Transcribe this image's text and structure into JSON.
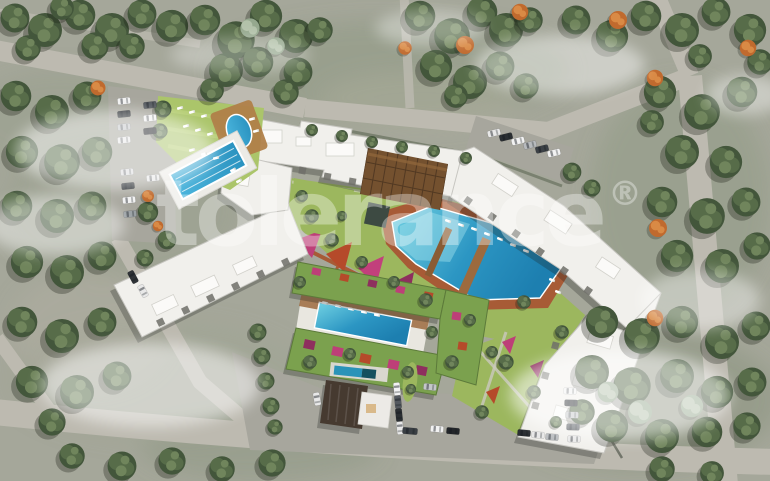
{
  "watermark": {
    "text": "tolerance",
    "symbol": "®"
  },
  "colors": {
    "ground": "#a5a79a",
    "road": "#bdbab0",
    "paving": "#a7a69d",
    "tree_dark": "#43563b",
    "tree_mid": "#576c49",
    "tree_light": "#70855c",
    "tree_sage": "#95a88e",
    "tree_autumn": "#c06a2e",
    "lawn": "#9cb75e",
    "lawn_bright": "#abc56a",
    "roof_white": "#f1f0ec",
    "roof_shade": "#d9d8d3",
    "roof_green": "#7ba14e",
    "flower_magenta": "#bd3f78",
    "flower_red": "#b54a2a",
    "pool_water": "#3fb0d6",
    "pool_deep": "#1f7fb0",
    "deck_wood": "#9c6a3e",
    "walkway_rust": "#a75b36",
    "pergola_brown": "#74512f",
    "clubhouse_roof": "#463a30"
  }
}
